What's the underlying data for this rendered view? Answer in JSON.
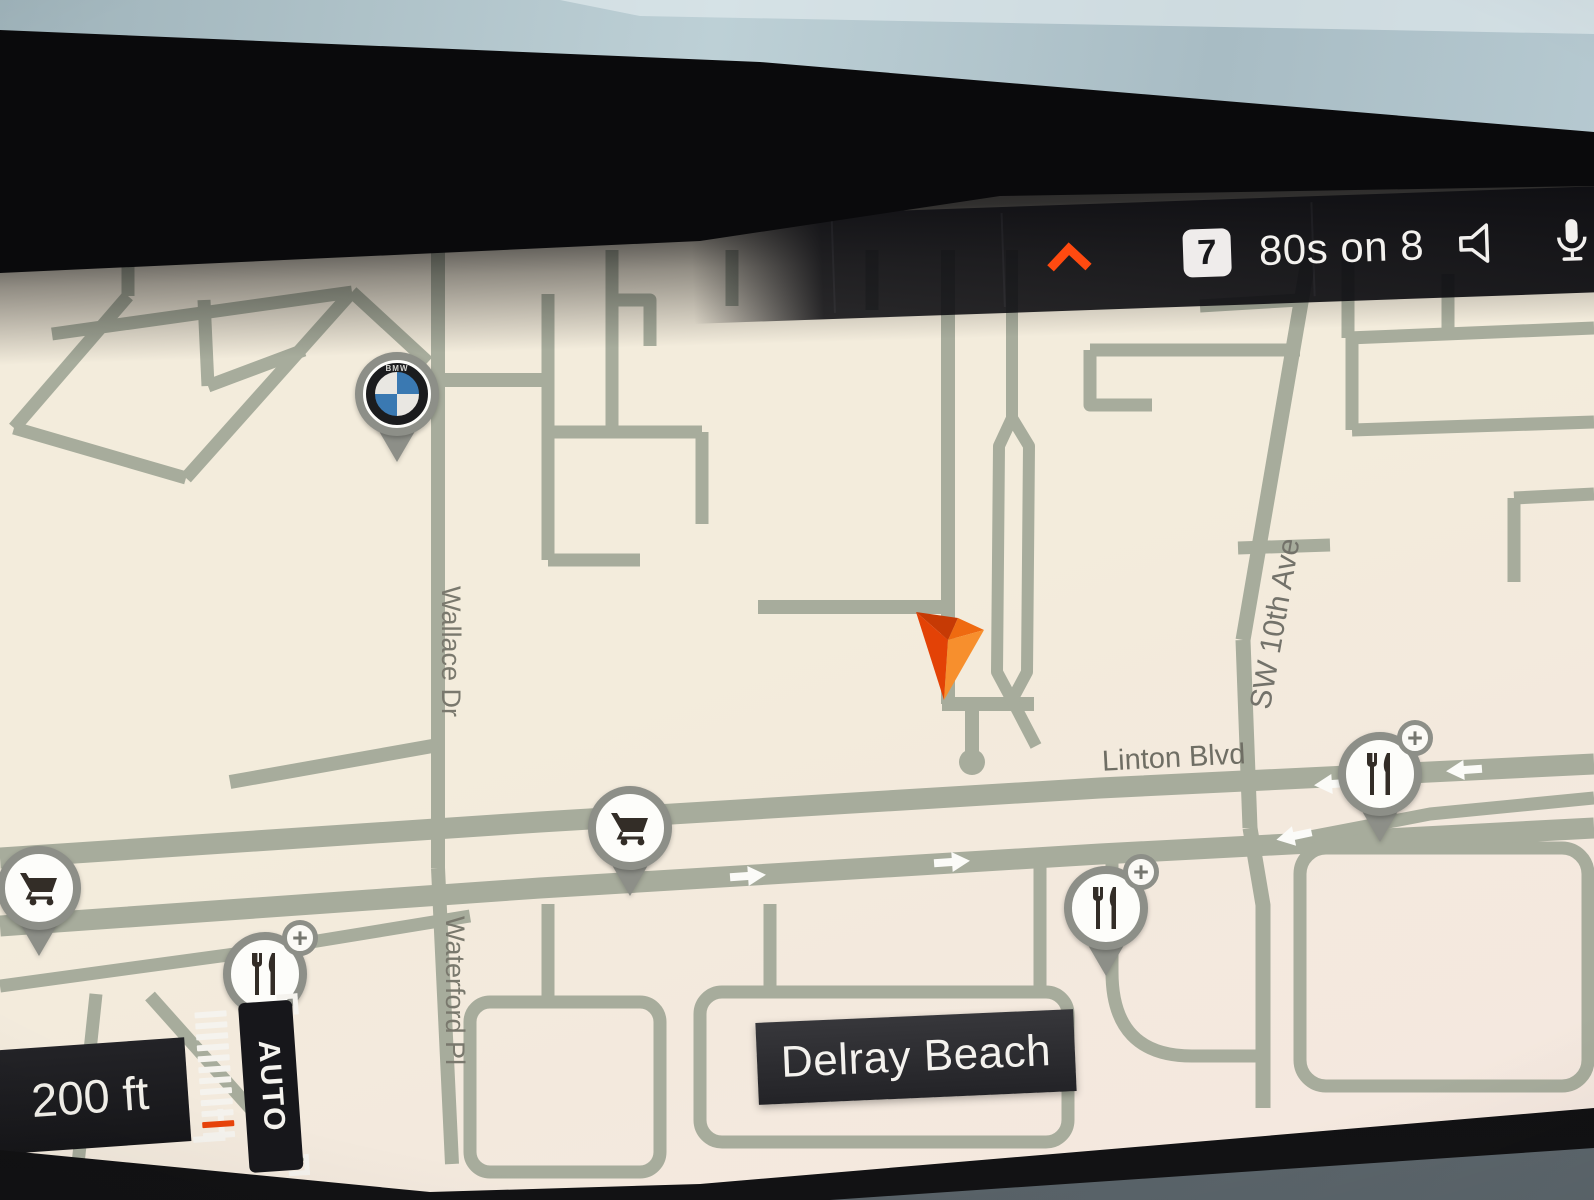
{
  "status_bar": {
    "preset_badge": "7",
    "media_title": "80s on 8",
    "icons": {
      "collapse": "chevron-up",
      "volume": "speaker",
      "voice": "microphone"
    },
    "accent_color": "#ff4a10"
  },
  "map": {
    "city_label": "Delray Beach",
    "streets": {
      "wallace": "Wallace Dr",
      "waterford": "Waterford Pl",
      "linton": "Linton Blvd",
      "sw10th": "SW 10th Ave"
    },
    "poi": {
      "bmw_pin_count": 1,
      "grocery_pin_count": 2,
      "restaurant_pin_count": 3,
      "plus_label": "+"
    },
    "bmw_text": "BMW",
    "vehicle_marker": "orange-navigation-arrow"
  },
  "zoom_control": {
    "scale_label": "200 ft",
    "auto_label": "AUTO"
  },
  "colors": {
    "accent_orange": "#ff4a10",
    "vehicle_orange": "#f07318",
    "map_bg": "#f2ead9",
    "road": "#a7ac9c",
    "panel_dark": "#1d1d21"
  }
}
